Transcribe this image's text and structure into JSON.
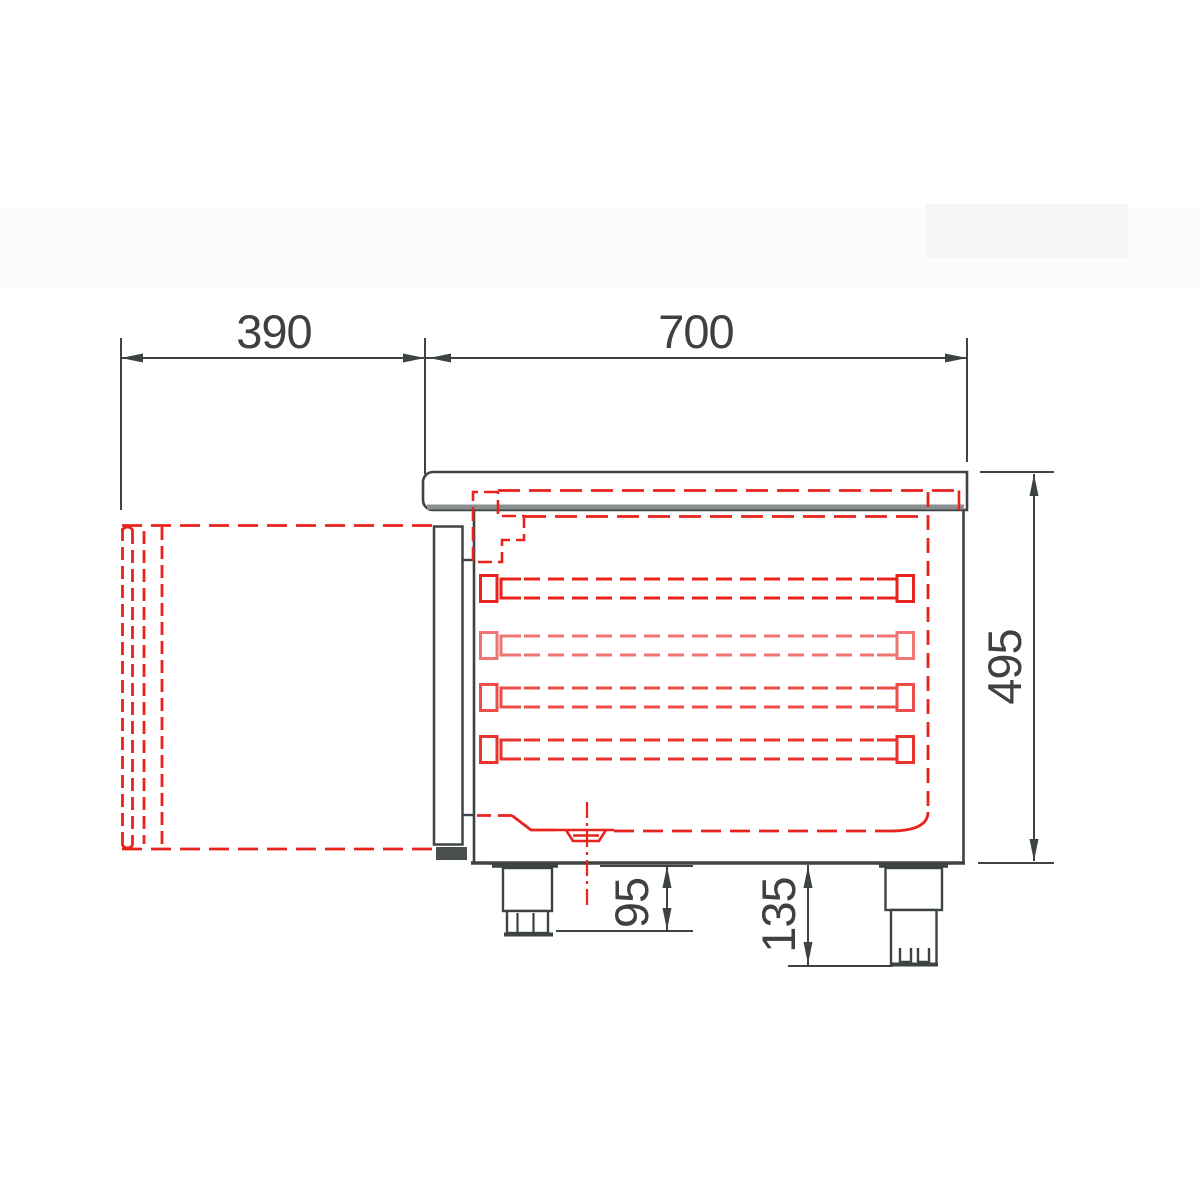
{
  "drawing": {
    "type": "technical side-view drawing of refrigerated counter with open door shown dashed",
    "dimensions": {
      "door_depth": "390",
      "body_depth": "700",
      "body_height": "495",
      "left_foot_height": "95",
      "right_foot_height": "135"
    },
    "colors": {
      "line": "#3d4242",
      "red": "#e8221c",
      "gray": "#8a8f8f",
      "text": "#3f4040",
      "band": "#f6f7f7"
    },
    "rails": {
      "count": 4,
      "y_tops": [
        579,
        636,
        688,
        740
      ],
      "line_gap": 19,
      "opacities": [
        1,
        0.62,
        0.8,
        0.92
      ]
    }
  }
}
